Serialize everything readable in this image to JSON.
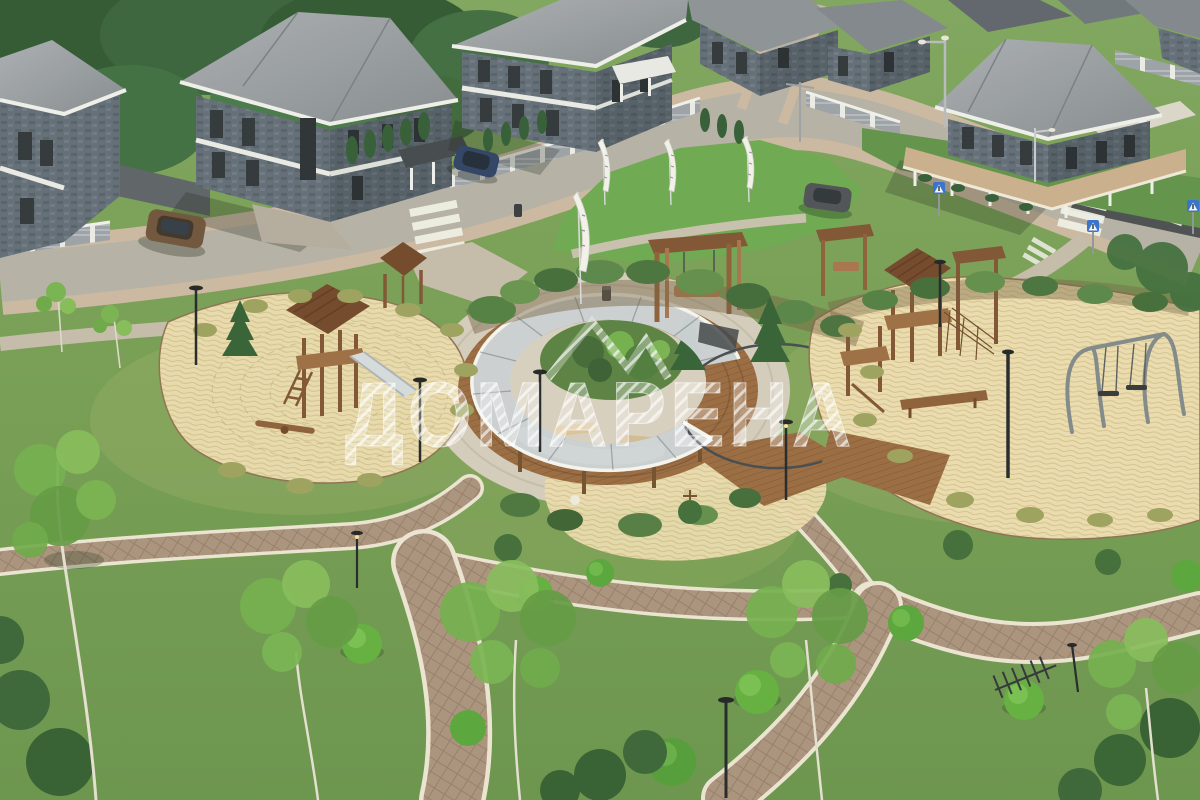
{
  "watermark": {
    "text": "ДОМАРЕНА",
    "logo": "double-peak-monogram",
    "color": "#ffffff",
    "opacity": 0.55
  },
  "scene": {
    "type": "aerial-3d-render",
    "subject": "cottage village courtyard: houses along road, central park with curved glass pavilion, two sand playgrounds, paver paths"
  },
  "counts": {
    "houses_visible": 8,
    "banner_flags": 4,
    "cars": 3,
    "pedestrian_crossing_signs": 3,
    "park_lamps": 8,
    "playgrounds": 2
  },
  "palette": {
    "grass": "#739c51",
    "lawn": "#69a84f",
    "sand": "#e8dcb0",
    "road": "#b3afa5",
    "sidewalk": "#c9b7a1",
    "paver_path": "#a8917c",
    "curb": "#e9e4d3",
    "deck_wood": "#96683f",
    "play_wood": "#8a5c36",
    "roof": "#949aa1",
    "wall_stone": "#5e6a75",
    "trim": "#eef0ed",
    "porch_roof_tan": "#c9ad8c",
    "glass_roof": "#ccd5da",
    "sign_blue": "#2f6fd1",
    "watermark": "#ffffff"
  }
}
